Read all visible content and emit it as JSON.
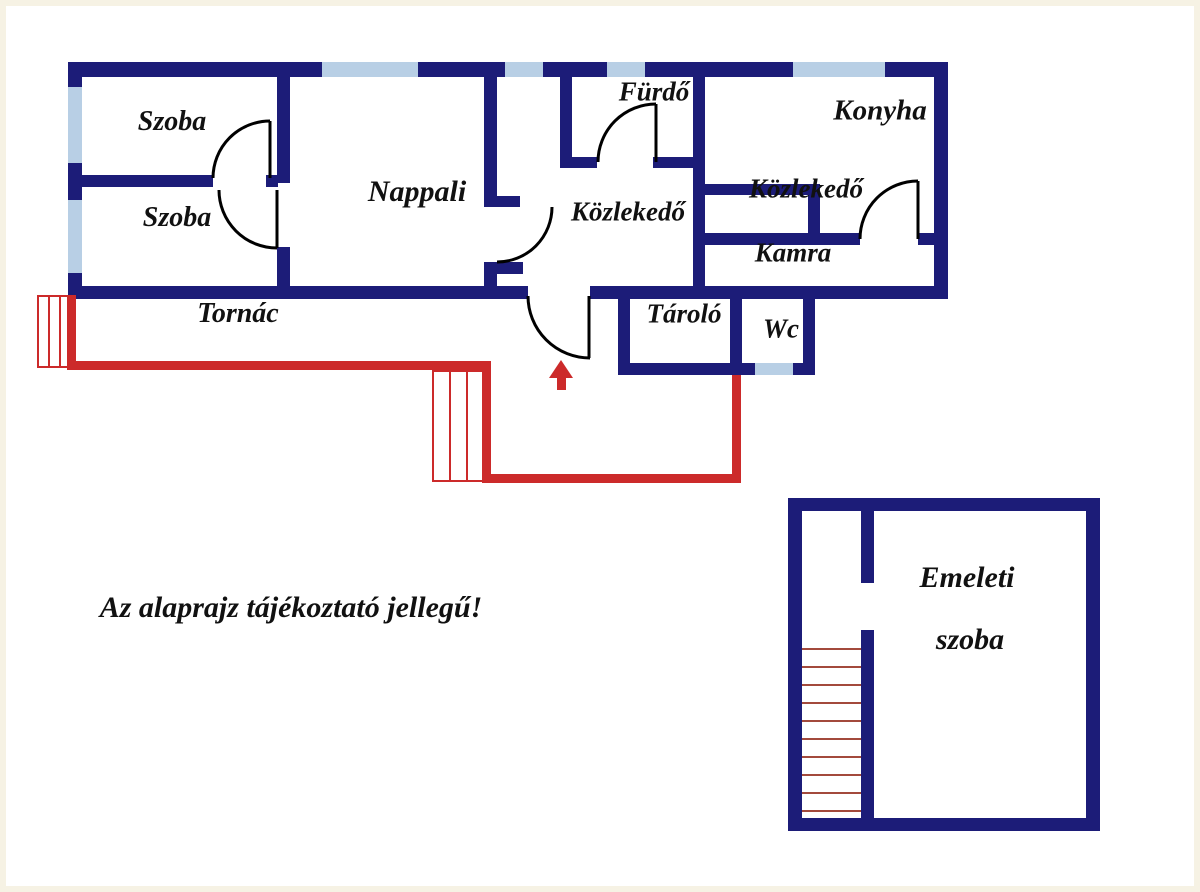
{
  "title": "Alaprajz (floor plan)",
  "note": "Az alaprajz tájékoztató jellegű!",
  "rooms": {
    "szoba1": "Szoba",
    "szoba2": "Szoba",
    "nappali": "Nappali",
    "furdo": "Fürdő",
    "konyha": "Konyha",
    "kozlekedo_center": "Közlekedő",
    "kozlekedo_right": "Közlekedő",
    "kamra": "Kamra",
    "tornac": "Tornác",
    "tarolo": "Tároló",
    "wc": "Wc",
    "emeleti_line1": "Emeleti",
    "emeleti_line2": "szoba"
  },
  "icons": {
    "entrance_arrow": "up-arrow marking main entrance"
  },
  "colors": {
    "wall": "#1c1c78",
    "window": "#b8cfe5",
    "outline_red": "#cc2a2a",
    "step_red": "#a34a3c",
    "door_black": "#000000",
    "text": "#111111"
  }
}
